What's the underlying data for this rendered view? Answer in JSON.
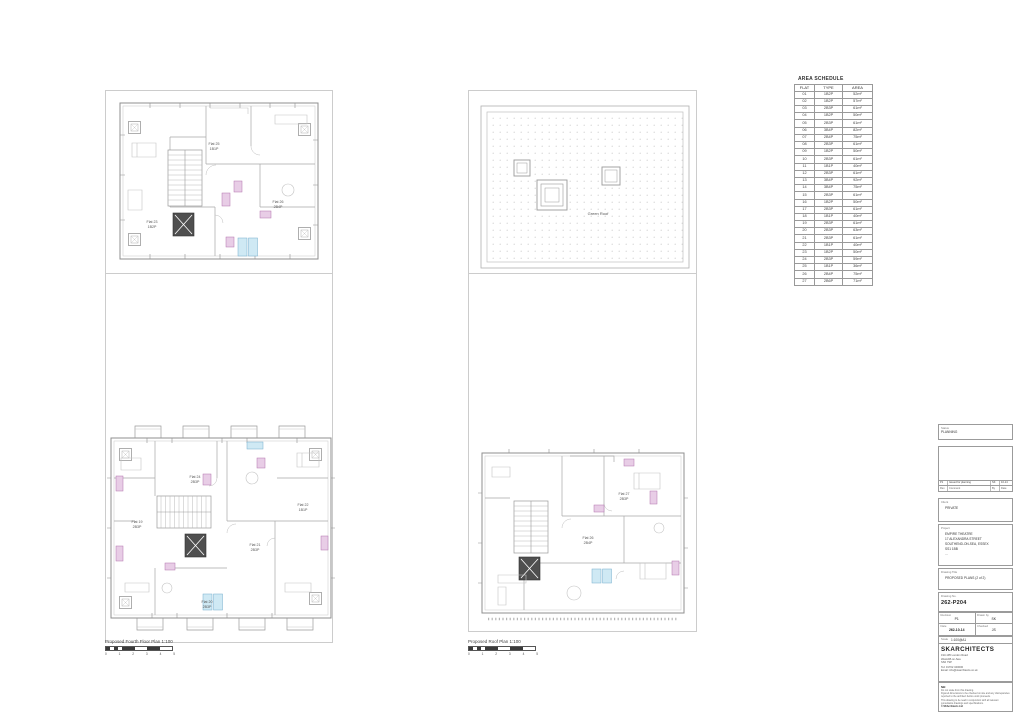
{
  "schedule": {
    "title": "AREA SCHEDULE",
    "headers": [
      "FLAT",
      "TYPE",
      "AREA"
    ],
    "rows": [
      [
        "01",
        "1B2P",
        "52m²"
      ],
      [
        "02",
        "1B2P",
        "57m²"
      ],
      [
        "03",
        "2B3P",
        "61m²"
      ],
      [
        "04",
        "1B2P",
        "50m²"
      ],
      [
        "05",
        "2B3P",
        "61m²"
      ],
      [
        "06",
        "3B4P",
        "82m²"
      ],
      [
        "07",
        "2B4P",
        "75m²"
      ],
      [
        "08",
        "2B3P",
        "61m²"
      ],
      [
        "09",
        "1B2P",
        "50m²"
      ],
      [
        "10",
        "2B3P",
        "61m²"
      ],
      [
        "11",
        "1B1P",
        "40m²"
      ],
      [
        "12",
        "2B3P",
        "61m²"
      ],
      [
        "13",
        "3B4P",
        "92m²"
      ],
      [
        "14",
        "3B4P",
        "75m²"
      ],
      [
        "15",
        "2B3P",
        "61m²"
      ],
      [
        "16",
        "1B2P",
        "50m²"
      ],
      [
        "17",
        "2B3P",
        "61m²"
      ],
      [
        "18",
        "1B1P",
        "40m²"
      ],
      [
        "19",
        "2B3P",
        "61m²"
      ],
      [
        "20",
        "2B3P",
        "63m²"
      ],
      [
        "21",
        "2B3P",
        "61m²"
      ],
      [
        "22",
        "1B1P",
        "40m²"
      ],
      [
        "23",
        "1B2P",
        "50m²"
      ],
      [
        "24",
        "2B3P",
        "59m²"
      ],
      [
        "25",
        "1B1P",
        "36m²"
      ],
      [
        "26",
        "2B4P",
        "75m²"
      ],
      [
        "27",
        "2B6P",
        "71m²"
      ]
    ]
  },
  "plans": {
    "left_caption": "Proposed Fourth Floor Plan 1:100",
    "mid_caption": "Proposed Roof Plan 1:100",
    "scale_numbers": [
      "0",
      "1",
      "2",
      "3",
      "4",
      "5"
    ],
    "flat_labels": {
      "a1": {
        "name": "Flat 25",
        "type": "1B1P"
      },
      "a2": {
        "name": "Flat 26",
        "type": "2B4P"
      },
      "a3": {
        "name": "Flat 23",
        "type": "1B2P"
      },
      "b1": {
        "name": "Flat 19",
        "type": "2B3P"
      },
      "b2": {
        "name": "Flat 24",
        "type": "2B3P"
      },
      "b3": {
        "name": "Flat 21",
        "type": "2B3P"
      },
      "b4": {
        "name": "Flat 22",
        "type": "1B1P"
      },
      "b5": {
        "name": "Flat 20",
        "type": "2B3P"
      },
      "c1": {
        "name": "Flat 27",
        "type": "2B3P"
      },
      "c2": {
        "name": "Flat 26",
        "type": "2B4P"
      },
      "roof": "Green Roof"
    }
  },
  "titleblock": {
    "status_label": "Status",
    "status_value": "PLANNING",
    "rev_entry": {
      "rev": "P1",
      "comment": "Issued for planning",
      "by": "SK",
      "date": "10-14"
    },
    "rev_headers": [
      "Rev",
      "Comment",
      "By",
      "Date"
    ],
    "client_label": "Client",
    "client_value": "PRIVATE",
    "project_label": "Project",
    "project_lines": [
      "EMPIRE THEATRE",
      "17 ALEXANDRA STREET",
      "SOUTHEND-ON-SEA, ESSEX",
      "SS1 1BB",
      "..."
    ],
    "drawing_title_label": "Drawing Title",
    "drawing_title_value": "PROPOSED PLANS (2 of 2)",
    "drawing_no_label": "Drawing No.",
    "drawing_no_value": "262-P204",
    "fields": [
      {
        "label": "Revision",
        "value": "P1"
      },
      {
        "label": "Drawn by",
        "value": "SK"
      },
      {
        "label": "Date",
        "value": "262-10-14"
      },
      {
        "label": "Checked",
        "value": "JS"
      }
    ],
    "scale_label": "Scale",
    "scale_value": "1:100@A1",
    "firm_name": "SKARCHITECTS",
    "firm_address": [
      "193-195 London Road",
      "Westcliff-on-Sea",
      "SS0 7SP"
    ],
    "firm_tel": "Tel: 01702 340000",
    "firm_email": "Email: info@skarchitects.co.uk",
    "notes_heading": "NB:",
    "notes_lines": [
      "Do not scale from this drawing.",
      "Figured dimensions to be checked on site and any discrepancies reported to the architect before work proceeds.",
      "This drawing to be read in conjunction with all relevant consultants drawings and specifications.",
      "© SKArchitects Ltd"
    ]
  }
}
